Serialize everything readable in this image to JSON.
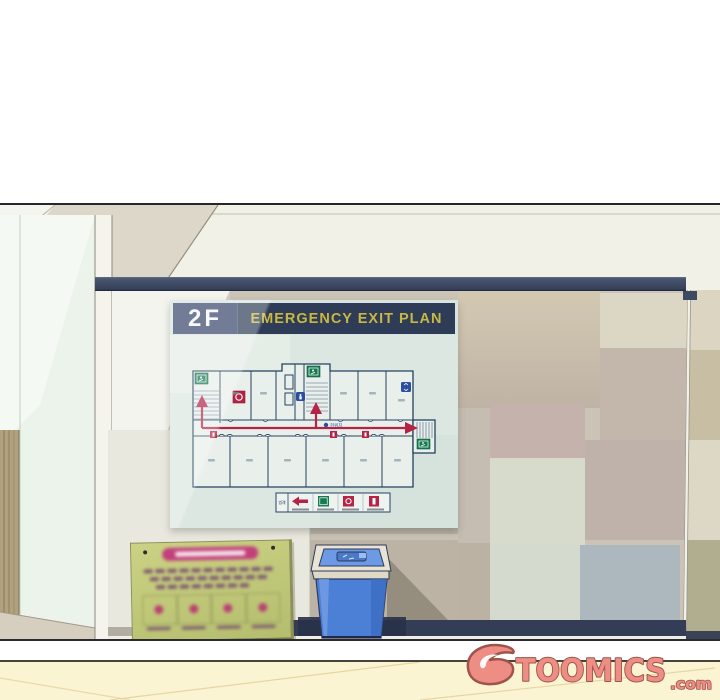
{
  "poster": {
    "floor_label": "2F",
    "title": "EMERGENCY EXIT PLAN",
    "you_are_here": "현위치",
    "legend_title": "범례",
    "legend_icons": [
      "route-arrow-icon",
      "emergency-exit-icon",
      "fire-alarm-icon",
      "fire-extinguisher-icon"
    ],
    "colors": {
      "header_bg": "#2e3c58",
      "floor_text": "#f5f6f8",
      "title_text": "#c8b840",
      "board_bg": "#d9e4e0",
      "plan_line": "#24435f",
      "route_red": "#b52347",
      "exit_green": "#157a52",
      "icon_blue": "#2b4fa0"
    }
  },
  "watermark": {
    "brand": "TOOMICS",
    "tld": ".com",
    "fill": "#ee8d84",
    "outline": "#9d544c"
  },
  "objects": {
    "trash_can": {
      "body_color": "#4c80d6",
      "lid_color": "#6d9ae4",
      "rim_color": "#e8e3d2"
    },
    "notice_board": {
      "face_color": "#c7ce7c",
      "banner_color": "#c2407c"
    }
  },
  "wall": {
    "rail_color": "#3a4763",
    "ceiling_color": "#f2f1e8",
    "baseboard_color": "#333d56",
    "floor_panel_color": "#fbf4d2"
  }
}
